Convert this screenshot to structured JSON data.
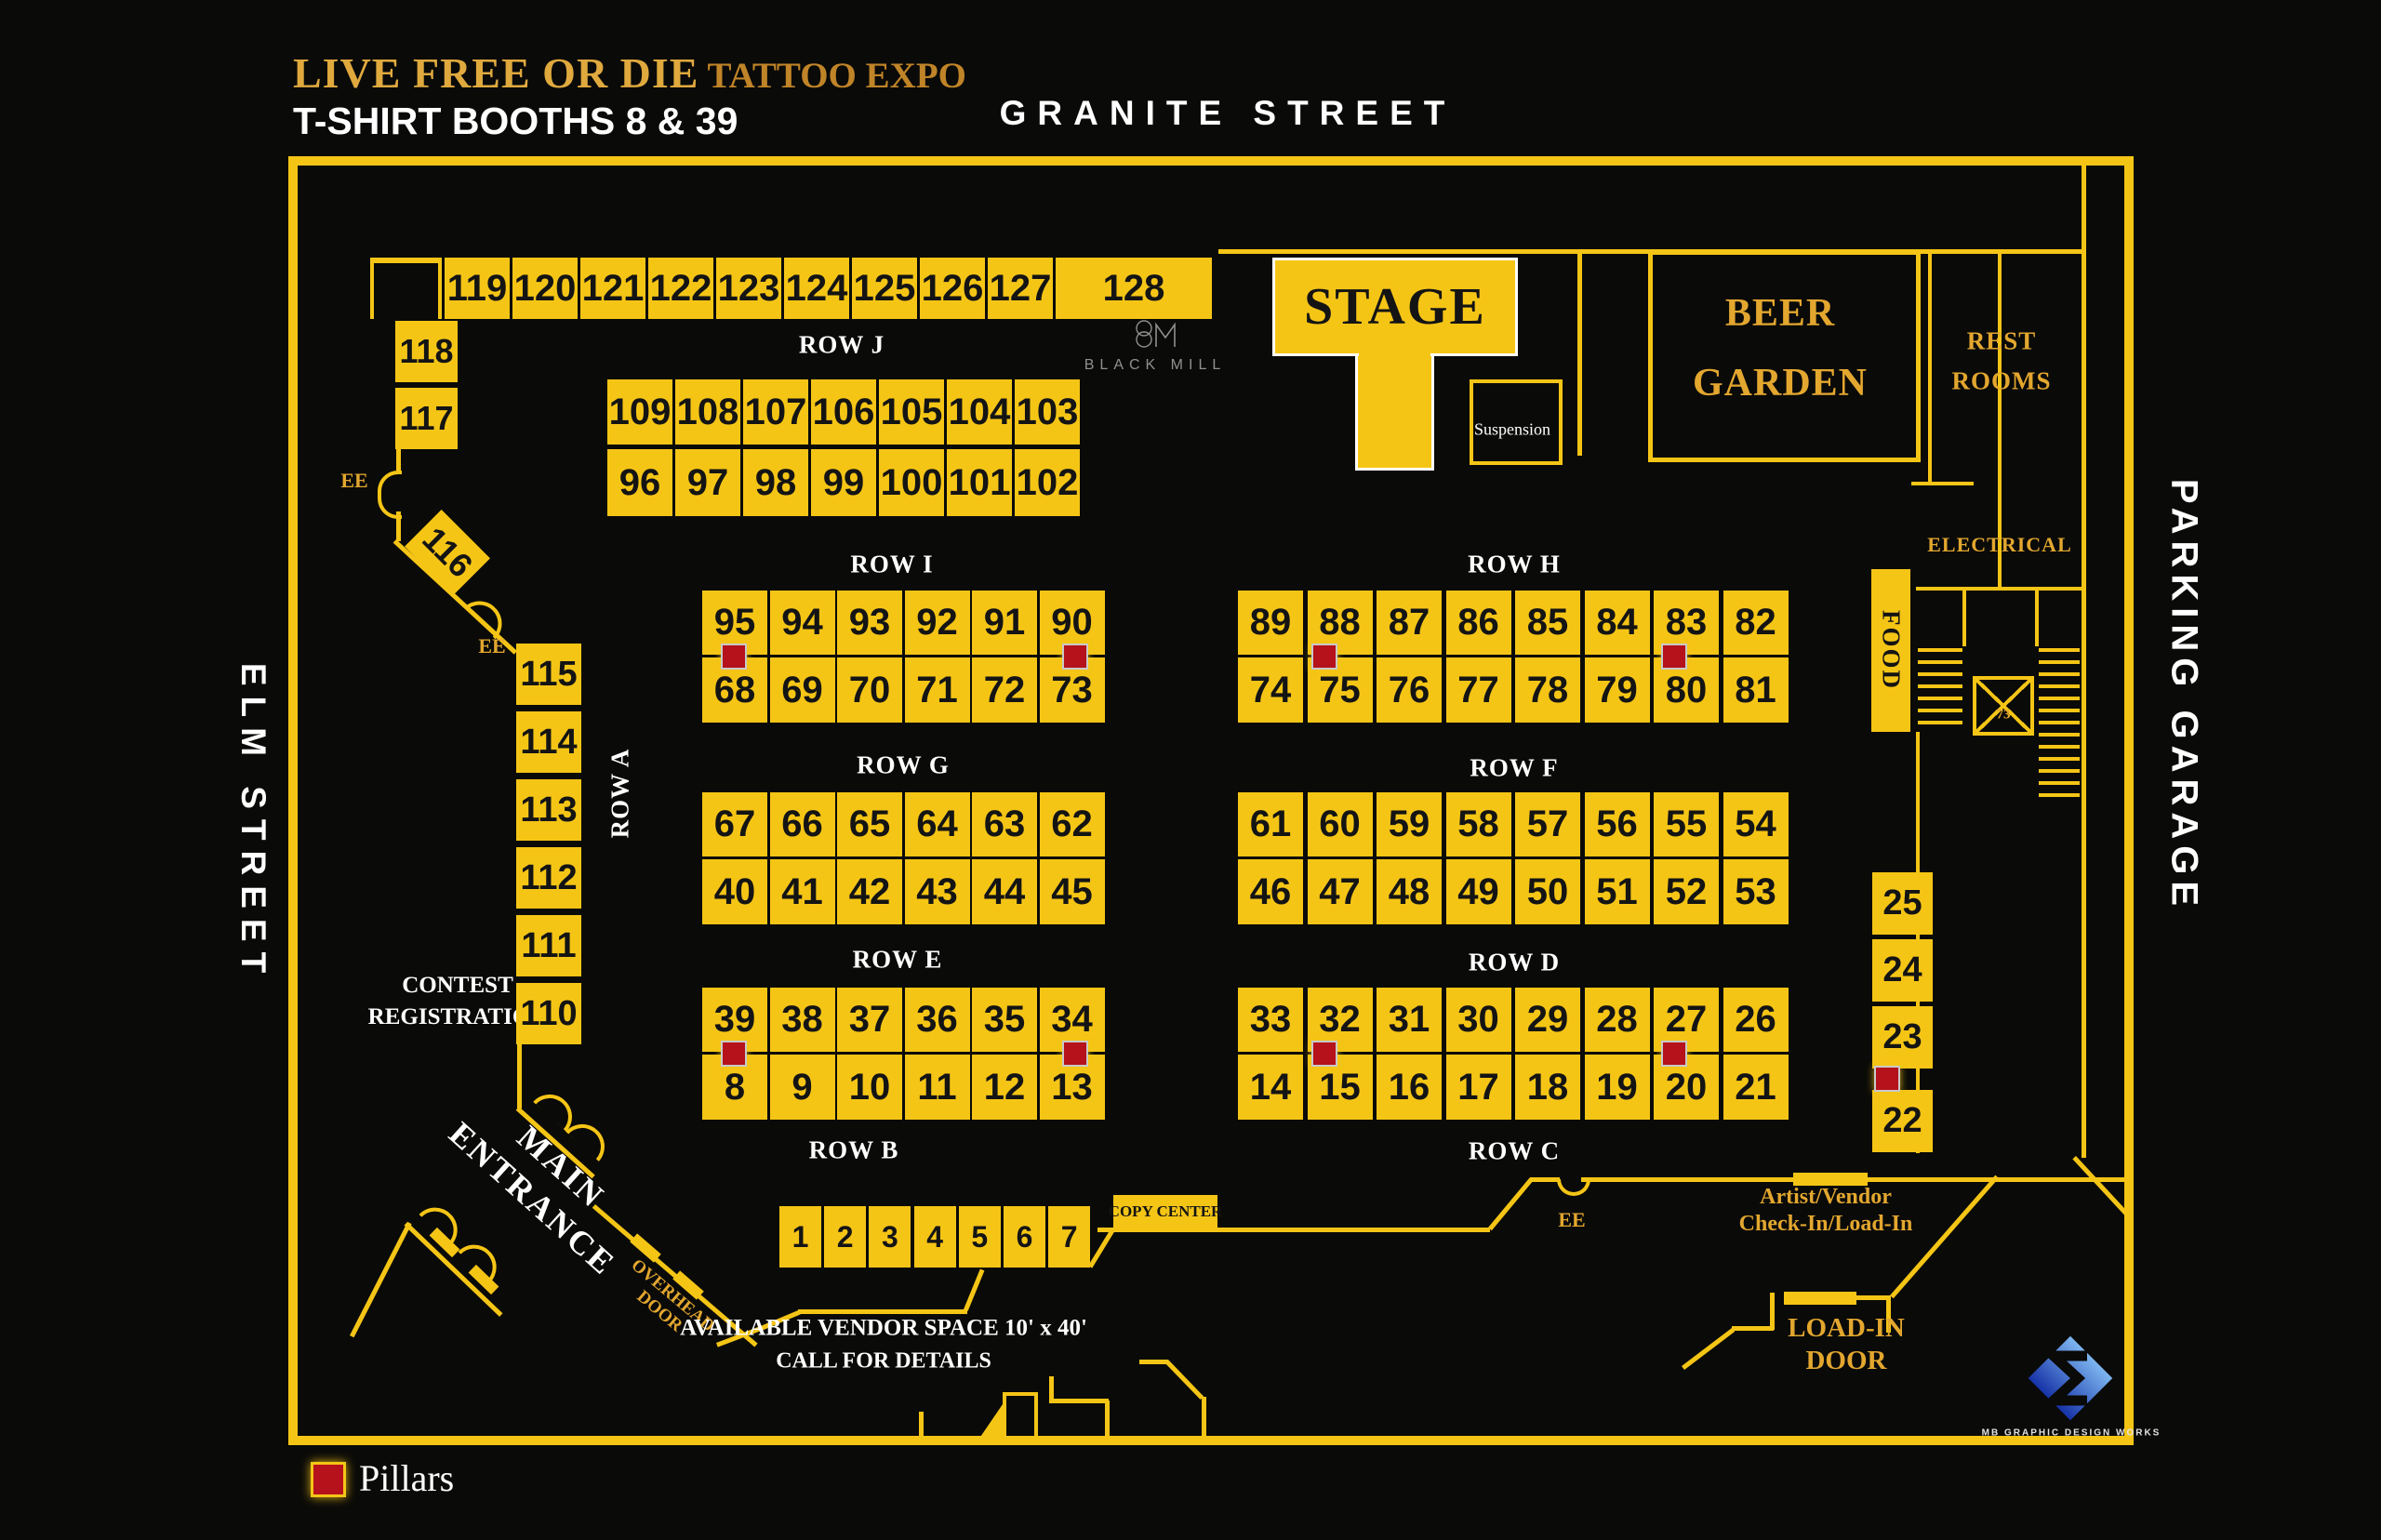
{
  "header": {
    "title_main": "LIVE FREE OR DIE",
    "title_accent": " TATTOO EXPO",
    "subtitle": "T-SHIRT BOOTHS 8 & 39"
  },
  "streets": {
    "top": "GRANITE STREET",
    "left": "ELM STREET",
    "right": "PARKING GARAGE"
  },
  "venue": {
    "stage": "STAGE",
    "suspension": "Suspension",
    "beer_garden_line1": "BEER",
    "beer_garden_line2": "GARDEN",
    "rest_rooms_line1": "REST",
    "rest_rooms_line2": "ROOMS",
    "electrical": "ELECTRICAL",
    "food": "FOOD",
    "elevator": "73",
    "copy_center": "COPY CENTER",
    "contest_line1": "CONTEST",
    "contest_line2": "REGISTRATION",
    "main_entrance_line1": "MAIN",
    "main_entrance_line2": "ENTRANCE",
    "overhead_door_line1": "OVERHEAD",
    "overhead_door_line2": "DOOR",
    "artist_vendor_line1": "Artist/Vendor",
    "artist_vendor_line2": "Check-In/Load-In",
    "load_in_line1": "LOAD-IN",
    "load_in_line2": "DOOR",
    "vendor_space_line1": "AVAILABLE VENDOR SPACE 10' x 40'",
    "vendor_space_line2": "CALL FOR DETAILS",
    "ee": "EE",
    "black_mill": "BLACK MILL",
    "mb_caption": "MB GRAPHIC DESIGN WORKS"
  },
  "legend": {
    "pillars": "Pillars"
  },
  "row_labels": {
    "a": "ROW A",
    "b": "ROW B",
    "c": "ROW C",
    "d": "ROW D",
    "e": "ROW E",
    "f": "ROW F",
    "g": "ROW G",
    "h": "ROW H",
    "i": "ROW I",
    "j": "ROW J"
  },
  "booths": {
    "top_strip": [
      "119",
      "120",
      "121",
      "122",
      "123",
      "124",
      "125",
      "126",
      "127",
      "128"
    ],
    "row_j_upper": [
      "109",
      "108",
      "107",
      "106",
      "105",
      "104",
      "103"
    ],
    "row_j_lower": [
      "96",
      "97",
      "98",
      "99",
      "100",
      "101",
      "102"
    ],
    "row_i_upper": [
      "95",
      "94",
      "93",
      "92",
      "91",
      "90"
    ],
    "row_i_lower": [
      "68",
      "69",
      "70",
      "71",
      "72",
      "73"
    ],
    "row_h_upper": [
      "89",
      "88",
      "87",
      "86",
      "85",
      "84",
      "83",
      "82"
    ],
    "row_h_lower": [
      "74",
      "75",
      "76",
      "77",
      "78",
      "79",
      "80",
      "81"
    ],
    "row_g_upper": [
      "67",
      "66",
      "65",
      "64",
      "63",
      "62"
    ],
    "row_g_lower": [
      "40",
      "41",
      "42",
      "43",
      "44",
      "45"
    ],
    "row_f_upper": [
      "61",
      "60",
      "59",
      "58",
      "57",
      "56",
      "55",
      "54"
    ],
    "row_f_lower": [
      "46",
      "47",
      "48",
      "49",
      "50",
      "51",
      "52",
      "53"
    ],
    "row_e_upper": [
      "39",
      "38",
      "37",
      "36",
      "35",
      "34"
    ],
    "row_e_lower": [
      "8",
      "9",
      "10",
      "11",
      "12",
      "13"
    ],
    "row_d_upper": [
      "33",
      "32",
      "31",
      "30",
      "29",
      "28",
      "27",
      "26"
    ],
    "row_d_lower": [
      "14",
      "15",
      "16",
      "17",
      "18",
      "19",
      "20",
      "21"
    ],
    "row_b": [
      "1",
      "2",
      "3",
      "4",
      "5",
      "6",
      "7"
    ],
    "left_upper": [
      "118",
      "117"
    ],
    "diagonal": "116",
    "row_a": [
      "115",
      "114",
      "113",
      "112",
      "111",
      "110"
    ],
    "right_col": [
      "25",
      "24",
      "23",
      "22"
    ]
  },
  "colors": {
    "yellow": "#F5C516",
    "gold_text": "#E3A72F",
    "pillar_red": "#B5121B",
    "background": "#0A0A08"
  }
}
